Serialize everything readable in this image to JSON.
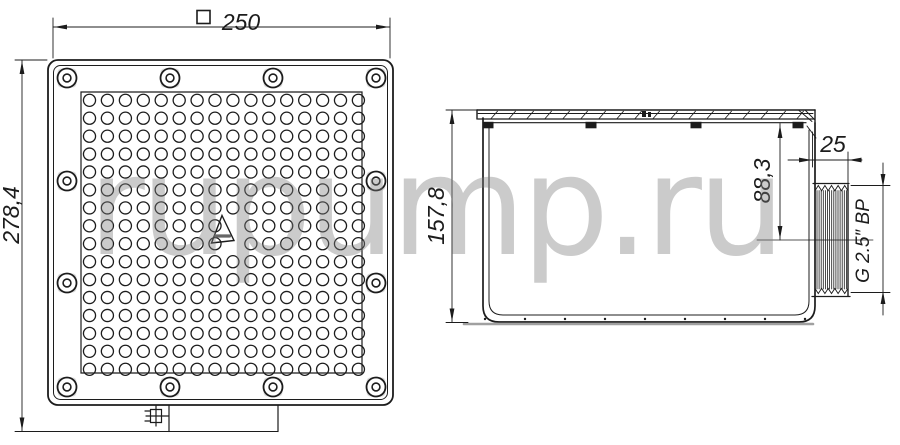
{
  "watermark": {
    "text": "rupump.ru",
    "color": "#d2d2d2"
  },
  "dimensions": {
    "top_width": {
      "symbol": "□",
      "value": "250"
    },
    "top_height": {
      "value": "278,4"
    },
    "side_height": {
      "value": "157,8"
    },
    "outlet_offset": {
      "value": "88,3"
    },
    "thread_stub_length": {
      "value": "25"
    },
    "thread_spec": {
      "value": "G 2.5″ BP"
    }
  },
  "grate": {
    "hole_grid": {
      "rows": 16,
      "cols": 16,
      "skipped_holes": [
        {
          "row": 7,
          "col": 8
        },
        {
          "row": 8,
          "col": 8
        }
      ]
    },
    "screw_count": 12,
    "clip_count": 4,
    "line_color": "#1c1c1c",
    "screw_pad_color": "#dcdcdc",
    "baseline_color": "#a0a0a0"
  }
}
